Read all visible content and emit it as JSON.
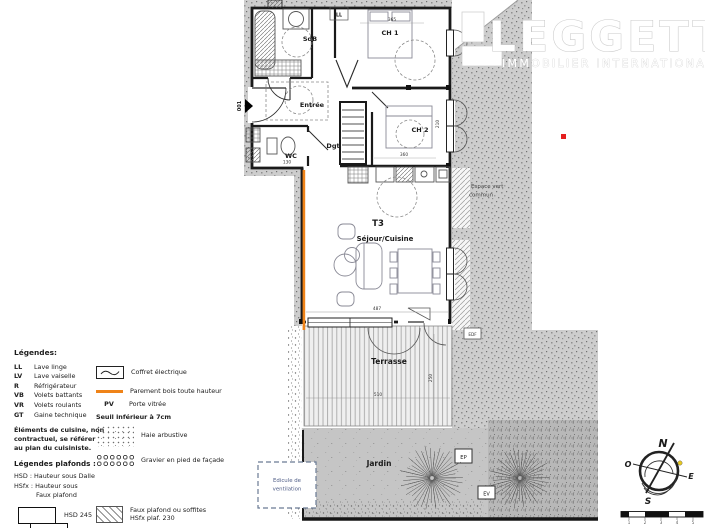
{
  "logo": {
    "name": "LEGGETT",
    "tagline": "IMMOBILIER INTERNATIONAL"
  },
  "plan": {
    "type_label": "T3",
    "entry_label": "001",
    "rooms": {
      "sdb": "SdB",
      "ch1": "CH 1",
      "ch2": "CH 2",
      "entree": "Entrée",
      "wc": "WC",
      "dgt": "Dgt",
      "sejour": "Séjour/Cuisine",
      "terrasse": "Terrasse",
      "jardin": "Jardin"
    },
    "appliances": {
      "ll": "LL"
    },
    "annotations": {
      "espace_vert_1": "Espace vert",
      "espace_vert_2": "commun",
      "edicule_1": "Edicule de",
      "edicule_2": "ventilation",
      "ep": "EP",
      "ev": "EV",
      "edf": "EDF"
    },
    "dimensions": {
      "sejour_width": "487",
      "terrasse_width": "510",
      "terrasse_depth": "250",
      "wc_width": "130",
      "ch2_width": "360",
      "ch1_width": "365",
      "ch2_depth": "210"
    }
  },
  "legend": {
    "title": "Légendes:",
    "items": [
      {
        "abbr": "LL",
        "label": "Lave linge"
      },
      {
        "abbr": "LV",
        "label": "Lave vaiselle"
      },
      {
        "abbr": "R",
        "label": "Réfrigérateur"
      },
      {
        "abbr": "VB",
        "label": "Volets battants"
      },
      {
        "abbr": "VR",
        "label": "Volets roulants"
      },
      {
        "abbr": "GT",
        "label": "Gaine technique"
      }
    ],
    "kitchen_note": "Éléments de cuisine, non contractuel, se référer au plan du cuisiniste.",
    "ceilings_title": "Légendes plafonds :",
    "hsd_def": "HSD : Hauteur sous Dalle",
    "hsfx_def_1": "HSfx : Hauteur sous",
    "hsfx_def_2": "Faux plafond",
    "hsd_box": "HSD 245",
    "coffret": "Coffret électrique",
    "parement": "Parement bois toute hauteur",
    "pv_abbr": "PV",
    "pv": "Porte vitrée",
    "seuil": "Seuil inférieur à 7cm",
    "haie": "Haie arbustive",
    "gravier": "Gravier en pied de façade",
    "faux_plafond_1": "Faux plafond ou soffites",
    "faux_plafond_2": "HSfx plaf. 230"
  },
  "compass": {
    "north": "N",
    "south": "S",
    "east": "E",
    "west": "O",
    "scale_ticks": [
      "1",
      "2",
      "3",
      "4",
      "5"
    ]
  },
  "colors": {
    "accent_orange": "#ef8318",
    "red_marker": "#e51f1f",
    "yellow_marker": "#e7c822",
    "legend_tan": "#f3d6a4"
  }
}
